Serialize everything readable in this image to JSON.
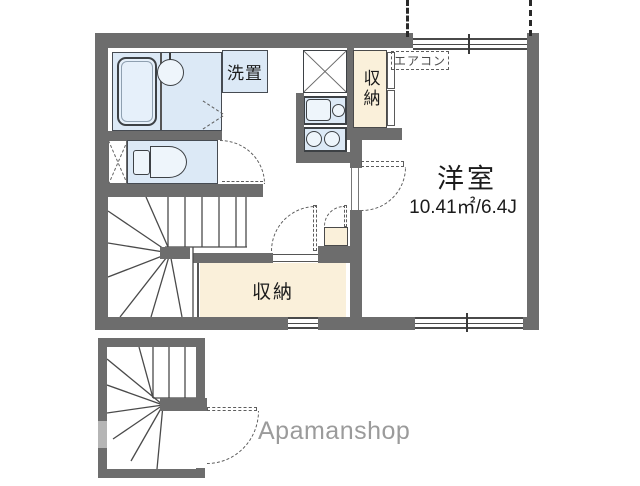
{
  "plan": {
    "labels": {
      "washer_space": "洗置",
      "storage_upper": "収納",
      "storage_lower": "収納",
      "aircon": "エアコン",
      "main_room_name": "洋室",
      "main_room_area": "10.41㎡/6.4J",
      "watermark": "Apamanshop"
    },
    "colors": {
      "wall": "#6d6d6d",
      "room_fill": "#dce9f6",
      "storage_fill": "#faf0da",
      "dash_line": "#5d5d5d",
      "watermark_text": "#9b9b9b"
    }
  }
}
